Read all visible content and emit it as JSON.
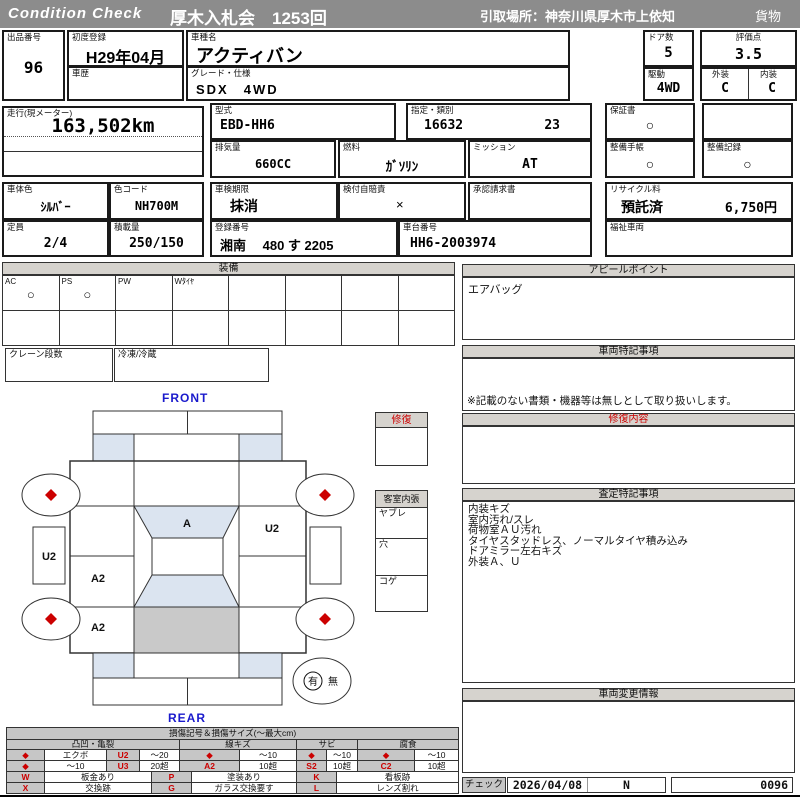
{
  "header": {
    "brand": "Condition  Check",
    "auction": "厚木入札会　1253回",
    "pickup": "引取場所：神奈川県厚木市上依知",
    "category": "貨物"
  },
  "vehicle": {
    "lot": {
      "label": "出品番号",
      "value": "96"
    },
    "first_reg": {
      "label": "初度登録",
      "value": "H29年04月"
    },
    "name": {
      "label": "車種名",
      "value": "アクティバン"
    },
    "history": {
      "label": "車歴",
      "value": ""
    },
    "grade": {
      "label": "グレード・仕様",
      "value": "SDX　4WD"
    },
    "doors": {
      "label": "ドア数",
      "value": "5"
    },
    "score": {
      "label": "評価点",
      "value": "3.5"
    },
    "drive": {
      "label": "駆動",
      "value": "4WD"
    },
    "exterior": {
      "label": "外装",
      "value": "C"
    },
    "interior": {
      "label": "内装",
      "value": "C"
    },
    "mileage": {
      "label": "走行(現メーター)",
      "value": "163,502km"
    },
    "model_code": {
      "label": "型式",
      "value": "EBD-HH6"
    },
    "type_class": {
      "label": "指定・類別",
      "type": "16632",
      "cls": "23"
    },
    "displacement": {
      "label": "排気量",
      "value": "660CC"
    },
    "fuel": {
      "label": "燃料",
      "value": "ｶﾞｿﾘﾝ"
    },
    "transmission": {
      "label": "ミッション",
      "value": "AT"
    },
    "warranty": {
      "label": "保証書",
      "value": "○"
    },
    "service_book": {
      "label": "整備手帳",
      "value": "○"
    },
    "service_record": {
      "label": "整備記録",
      "value": "○"
    },
    "body_color": {
      "label": "車体色",
      "value": "ｼﾙﾊﾞｰ"
    },
    "color_code": {
      "label": "色コード",
      "value": "NH700M"
    },
    "capacity": {
      "label": "定員",
      "value": "2/4"
    },
    "payload": {
      "label": "積載量",
      "value": "250/150"
    },
    "inspection": {
      "label": "車検期限",
      "value": "抹消"
    },
    "insurance": {
      "label": "検付自賠責",
      "value": "×"
    },
    "approval": {
      "label": "承認請求書",
      "value": ""
    },
    "reg_no": {
      "label": "登録番号",
      "value": "湘南　 480 す 2205"
    },
    "chassis": {
      "label": "車台番号",
      "value": "HH6-2003974"
    },
    "recycle": {
      "label": "リサイクル料",
      "status": "預託済",
      "fee": "6,750円"
    },
    "welfare": {
      "label": "福祉車両",
      "value": ""
    }
  },
  "equipment": {
    "title": "装備",
    "cols": [
      {
        "label": "AC",
        "mark": "○"
      },
      {
        "label": "PS",
        "mark": "○"
      },
      {
        "label": "PW",
        "mark": ""
      },
      {
        "label": "Wﾀｲﾔ",
        "mark": ""
      },
      {
        "label": "",
        "mark": ""
      },
      {
        "label": "",
        "mark": ""
      },
      {
        "label": "",
        "mark": ""
      },
      {
        "label": "",
        "mark": ""
      }
    ],
    "crane_label": "クレーン段数",
    "reefer_label": "冷凍/冷蔵"
  },
  "diagram": {
    "front": "FRONT",
    "rear": "REAR",
    "repair_title": "修復",
    "cabin_title": "客室内張",
    "cabin_items": [
      "ヤブレ",
      "穴",
      "コゲ"
    ],
    "spare_yes": "有",
    "spare_no": "無",
    "marks": {
      "windshield": "A",
      "right_door": "U2",
      "left_trim": "U2",
      "left_center": "A2",
      "left_rear": "A2"
    }
  },
  "panels": {
    "appeal": {
      "title": "アピールポイント",
      "content": "エアバッグ"
    },
    "special": {
      "title": "車両特記事項",
      "note": "※記載のない書類・機器等は無しとして取り扱いします。"
    },
    "repair": {
      "title": "修復内容"
    },
    "assessment": {
      "title": "査定特記事項",
      "lines": [
        "内装キズ",
        "室内汚れ/スレ",
        "荷物室ＡＵ汚れ",
        "タイヤスタッドレス、ノーマルタイヤ積み込み",
        "ドアミラー左右キズ",
        "外装Ａ、Ｕ"
      ]
    },
    "change": {
      "title": "車両変更情報"
    }
  },
  "legend": {
    "title": "損傷記号＆損傷サイズ(～最大cm)",
    "groups": [
      "凸凹・亀裂",
      "線キズ",
      "サビ",
      "腐食"
    ],
    "rows": [
      [
        "◆",
        "エクボ",
        "U2",
        "～20",
        "◆",
        "～10",
        "◆",
        "～10",
        "◆",
        "～10"
      ],
      [
        "◆",
        "～10",
        "U3",
        "20超",
        "A2",
        "10超",
        "S2",
        "10超",
        "C2",
        "10超"
      ]
    ],
    "codes": [
      [
        "W",
        "板金あり",
        "P",
        "塗装あり",
        "K",
        "看板跡"
      ],
      [
        "X",
        "交換跡",
        "G",
        "ガラス交換要す",
        "L",
        "レンズ割れ"
      ]
    ]
  },
  "check": {
    "label": "チェック",
    "date": "2026/04/08",
    "mark": "N",
    "number": "0096"
  },
  "colors": {
    "accent_red": "#cc0000",
    "glass_blue": "#dbe4f0",
    "bar_gray": "#8c8c8c"
  }
}
